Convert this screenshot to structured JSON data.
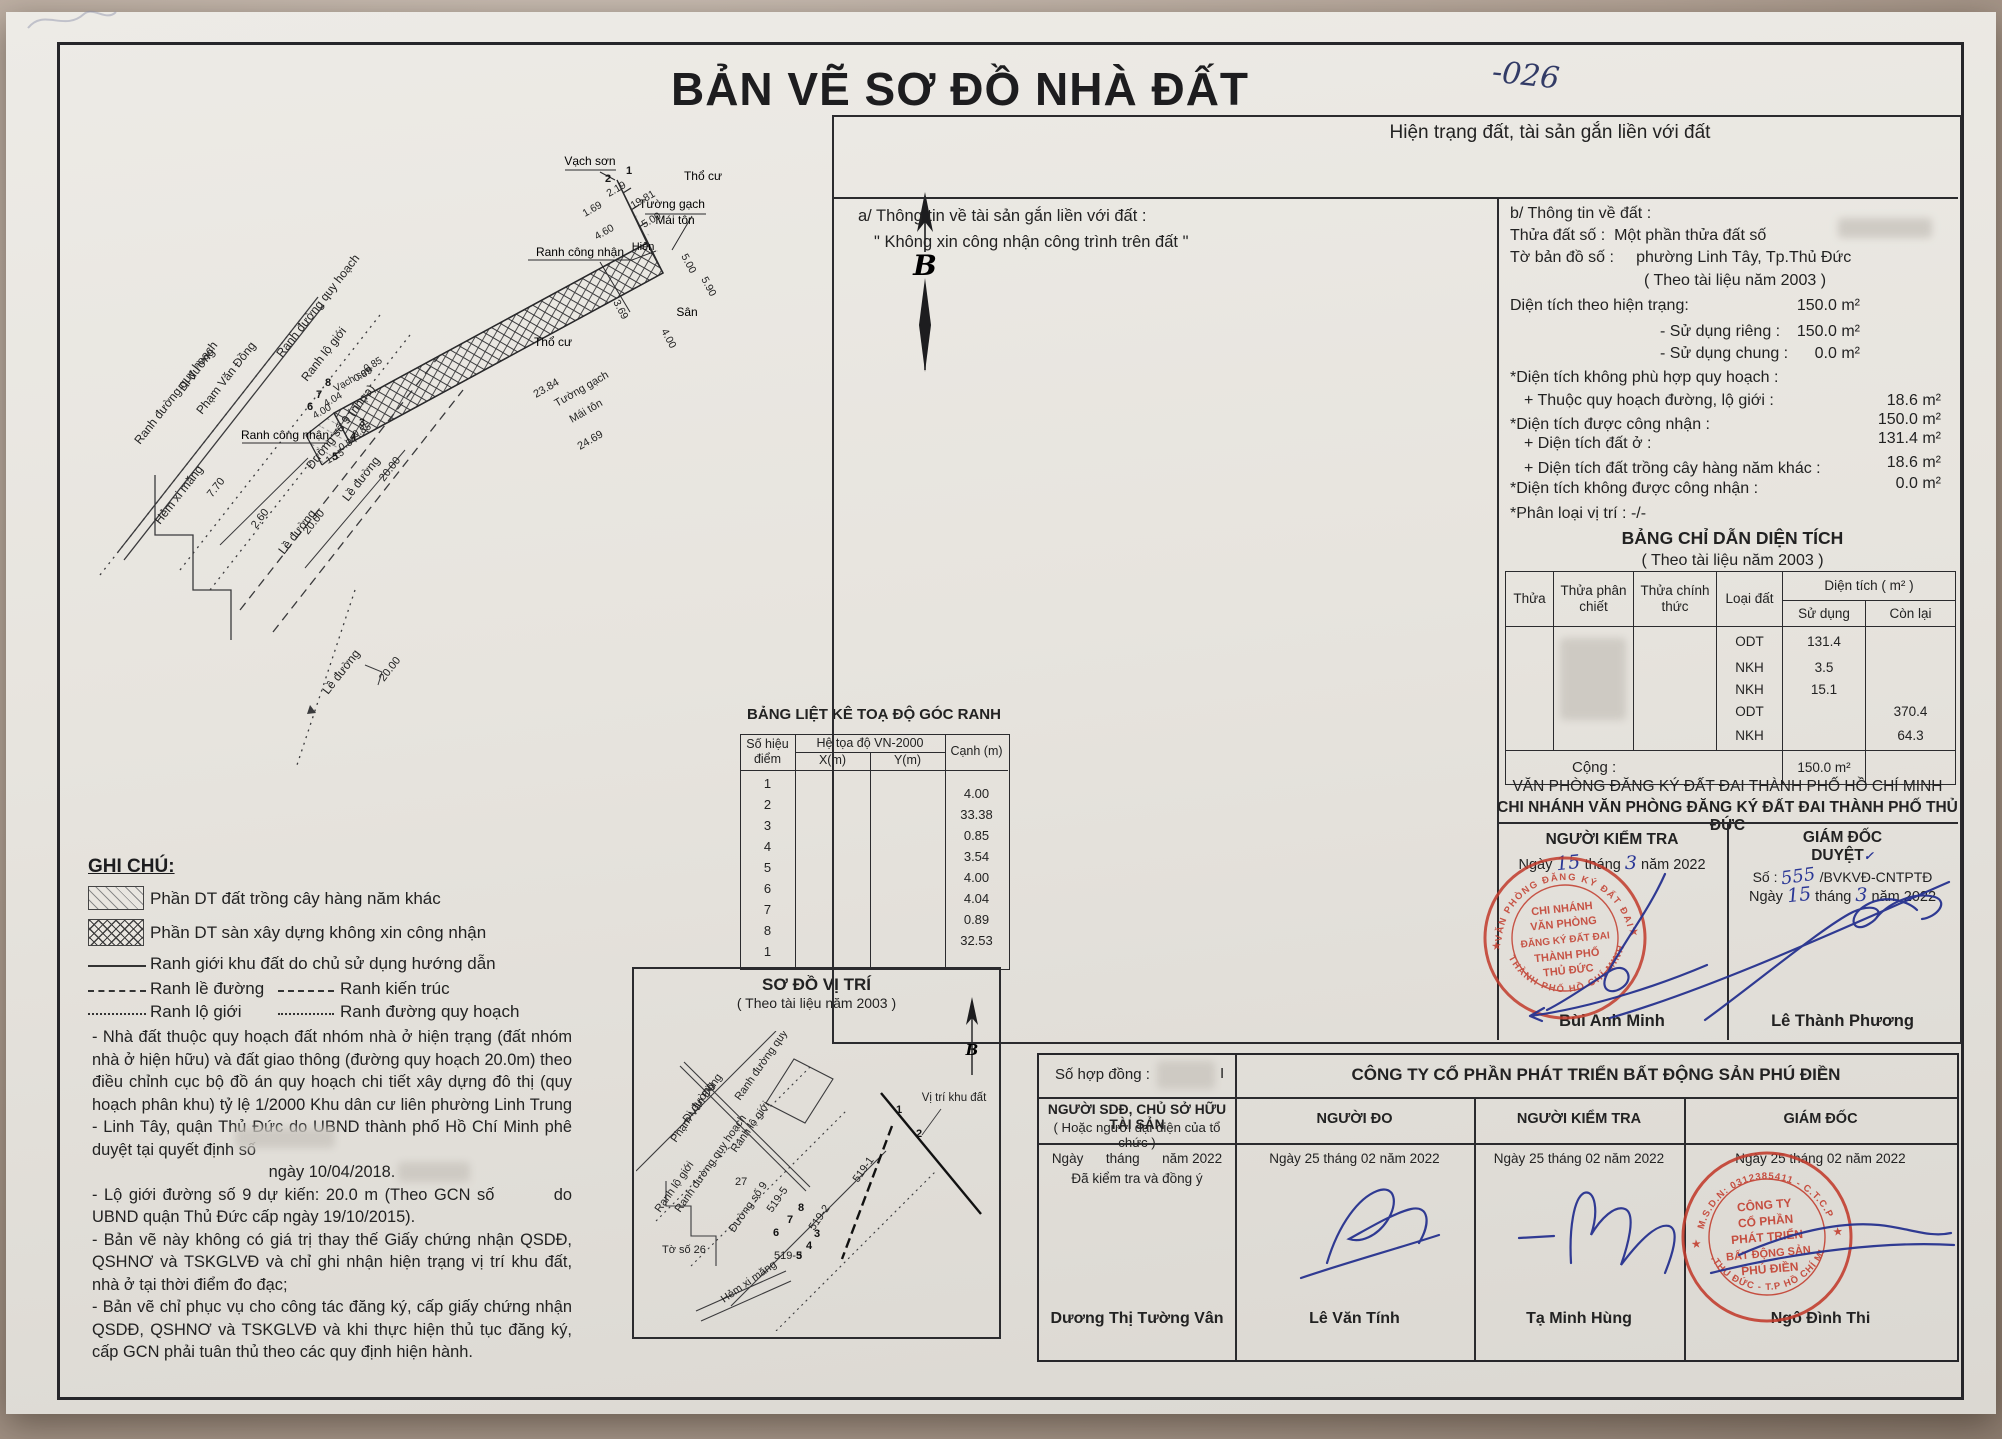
{
  "colors": {
    "paper": "#e7e4de",
    "ink": "#1d1d1f",
    "pen_blue": "#2a3796",
    "stamp_red": "#c23b2c"
  },
  "page": {
    "title": "BẢN VẼ SƠ ĐỒ NHÀ ĐẤT",
    "handwritten_code": "-026",
    "north": "B"
  },
  "drawing": {
    "labels": {
      "tuong_gach": "Tường gạch",
      "mai_ton": "Mái tôn",
      "vach_son": "Vạch sơn",
      "tho_cu": "Thổ cư",
      "san": "Sân",
      "hien": "Hiên",
      "ranh_cong_nhan": "Ranh công nhận",
      "ranh_duong_quy_hoach": "Ranh đường quy hoạch",
      "ranh_lo_gioi": "Ranh lộ giới",
      "ranh_kien_truc": "Ranh kiến trúc",
      "di_duong": "Đi đường",
      "pham_van_dong": "Phạm Văn Đồng",
      "duong_so_9_nhua": "Đường số 9 (nhựa)",
      "hem_xi_mang": "Hẻm xi măng",
      "le_duong": "Lề đường"
    },
    "dims": {
      "d2384": "23.84",
      "d2469": "24.69",
      "d369": "3.69",
      "d400": "4.00",
      "d500": "5.00",
      "d590": "5.90",
      "d169": "1.69",
      "d460": "4.60",
      "d219": "2.19",
      "d1981": "19.81",
      "d089": "0.89",
      "d404": "4.04",
      "d085": "0.85",
      "d115": "1.15",
      "d054": "0.54",
      "d2000": "20.00",
      "d770": "7.70",
      "d260": "2.60"
    },
    "points": [
      "1",
      "2",
      "3",
      "4",
      "5",
      "6",
      "7",
      "8"
    ]
  },
  "legend": {
    "heading": "GHI CHÚ:",
    "hatch1": "Phần DT đất trồng cây hàng năm khác",
    "hatch2": "Phần DT sàn xây dựng không xin công nhận",
    "solid": "Ranh giới khu đất do chủ sử dụng hướng dẫn",
    "dash1": "Ranh lề đường",
    "dash2": "Ranh kiến trúc",
    "dot1": "Ranh lộ giới",
    "dot2": "Ranh đường quy hoạch"
  },
  "notes": {
    "p1": "- Nhà đất thuộc quy hoạch đất nhóm nhà ở hiện trạng (đất nhóm nhà  ở hiện hữu) và đất giao thông (đường quy hoạch 20.0m) theo điều chỉnh cục bộ đồ án quy hoạch chi tiết xây dựng đô thị (quy hoạch phân khu) tỷ lệ 1/2000 Khu dân cư liên phường Linh Trung - Linh Tây, quận Thủ Đức do UBND thành phố Hồ Chí Minh phê duyệt tại quyết định số",
    "p1_date": "ngày 10/04/2018.",
    "p2": "- Lộ giới đường số 9 dự kiến: 20.0 m (Theo GCN số         do UBND quận Thủ Đức cấp ngày 19/10/2015).",
    "p3": "- Bản vẽ này không có giá trị thay thế Giấy chứng nhận QSDĐ, QSHNƠ và TSKGLVĐ và chỉ ghi nhận hiện trạng vị trí khu đất, nhà ở tại thời điểm đo đạc;",
    "p4": "- Bản vẽ chỉ phục vụ cho công tác đăng ký, cấp giấy chứng nhận QSDĐ, QSHNƠ và TSKGLVĐ và khi thực hiện thủ tục đăng ký, cấp GCN phải tuân thủ theo các quy định hiện hành."
  },
  "coord_table": {
    "title": "BẢNG LIỆT KÊ TOẠ ĐỘ GÓC RANH",
    "col_point1": "Số hiệu",
    "col_point2": "điểm",
    "col_sys": "Hệ tọa độ VN-2000",
    "col_x": "X(m)",
    "col_y": "Y(m)",
    "col_edge": "Cạnh (m)",
    "rows": [
      {
        "p": "1",
        "c": "4.00"
      },
      {
        "p": "2",
        "c": "33.38"
      },
      {
        "p": "3",
        "c": "0.85"
      },
      {
        "p": "4",
        "c": "3.54"
      },
      {
        "p": "5",
        "c": "4.00"
      },
      {
        "p": "6",
        "c": "4.04"
      },
      {
        "p": "7",
        "c": "0.89"
      },
      {
        "p": "8",
        "c": "32.53"
      },
      {
        "p": "1",
        "c": ""
      }
    ]
  },
  "location_map": {
    "title": "SƠ ĐỒ VỊ TRÍ",
    "subtitle": "( Theo tài liệu năm 2003 )",
    "labels": {
      "vi_tri": "Vị trí khu đất",
      "to_so": "Tờ số 26",
      "duong_so_9": "Đường số 9",
      "s519_1": "519-1",
      "s519_2": "519-2",
      "s519_3": "519-3",
      "s519_5": "519-5",
      "n27": "27"
    }
  },
  "info": {
    "header": "Hiện trạng đất, tài sản gắn liền với đất",
    "a_title": "a/ Thông tin về tài sản gắn liền với đất :",
    "a_note": "\" Không xin công nhận công trình trên đất \"",
    "b_title": "b/ Thông tin về đất :",
    "thua_label": "Thửa đất số :",
    "thua_value": "Một phần thửa đất số",
    "to_label": "Tờ bản đồ số :",
    "to_value": "phường Linh Tây, Tp.Thủ Đức",
    "doc_year": "( Theo tài liệu năm 2003 )",
    "rows": [
      {
        "label": "Diện tích theo hiện trạng:",
        "value": "150.0 m²"
      },
      {
        "label": "- Sử dụng riêng :",
        "value": "150.0 m²"
      },
      {
        "label": "- Sử dụng chung :",
        "value": "0.0 m²"
      },
      {
        "label": "*Diện tích không phù hợp quy hoạch :",
        "value": ""
      },
      {
        "label": "+ Thuộc quy hoạch đường, lộ giới :",
        "value": "18.6 m²"
      },
      {
        "label": "*Diện tích được công nhận :",
        "value": "150.0 m²"
      },
      {
        "label": "+ Diện tích đất ở :",
        "value": "131.4 m²"
      },
      {
        "label": "+ Diện tích đất trồng cây hàng năm khác :",
        "value": "18.6 m²"
      },
      {
        "label": "*Diện tích không được công nhận :",
        "value": "0.0 m²"
      },
      {
        "label": "*Phân loại vị trí :  -/-",
        "value": ""
      }
    ]
  },
  "area_table": {
    "title": "BẢNG CHỈ DẪN DIỆN TÍCH",
    "subtitle": "( Theo tài liệu năm 2003 )",
    "headers": {
      "thua": "Thửa",
      "phan_chiet": "Thửa phân chiết",
      "chinh_thuc": "Thửa chính thức",
      "loai_dat": "Loại đất",
      "dien_tich": "Diện tích   ( m² )",
      "su_dung": "Sử dụng",
      "con_lai": "Còn lại"
    },
    "rows": [
      {
        "loai": "ODT",
        "su_dung": "131.4",
        "con_lai": ""
      },
      {
        "loai": "NKH",
        "su_dung": "3.5",
        "con_lai": ""
      },
      {
        "loai": "NKH",
        "su_dung": "15.1",
        "con_lai": ""
      },
      {
        "loai": "ODT",
        "su_dung": "",
        "con_lai": "370.4"
      },
      {
        "loai": "NKH",
        "su_dung": "",
        "con_lai": "64.3"
      }
    ],
    "total_label": "Cộng :",
    "total_value": "150.0 m²"
  },
  "registry": {
    "line1": "VĂN PHÒNG ĐĂNG KÝ ĐẤT ĐAI THÀNH PHỐ HỒ CHÍ MINH",
    "line2": "CHI NHÁNH VĂN PHÒNG ĐĂNG KÝ ĐẤT ĐAI THÀNH PHỐ THỦ ĐỨC",
    "checker": {
      "title": "NGƯỜI KIỂM TRA",
      "d1": "Ngày",
      "day": "15",
      "d2": "tháng",
      "month": "3",
      "d3": "năm 2022",
      "name": "Bùi Anh Minh"
    },
    "director": {
      "title": "GIÁM ĐỐC",
      "duyet": "DUYỆT",
      "tick": "✓",
      "so_label": "Số :",
      "so_value": "555",
      "so_suffix": "/BVKVĐ-CNTPTĐ",
      "d1": "Ngày",
      "day": "15",
      "d2": "tháng",
      "month": "3",
      "d3": "năm 2022",
      "name": "Lê Thành Phương"
    },
    "stamp": {
      "arc_top": "VĂN PHÒNG ĐĂNG KÝ ĐẤT ĐAI",
      "arc_bottom": "THÀNH PHỐ HỒ CHÍ MINH",
      "l1": "CHI NHÁNH",
      "l2": "VĂN PHÒNG",
      "l3": "ĐĂNG KÝ ĐẤT ĐAI",
      "l4": "THÀNH PHỐ",
      "l5": "THỦ ĐỨC",
      "star": "★"
    }
  },
  "contract": {
    "so_hop_dong": "Số hợp đồng :",
    "so_hop_dong_value": "I",
    "company": "CÔNG TY CỔ PHẦN PHÁT TRIỂN BẤT ĐỘNG SẢN PHÚ ĐIỀN",
    "col1_title": "NGƯỜI SDĐ, CHỦ SỞ HỮU TÀI SẢN",
    "col1_sub": "( Hoặc người đại diện của tổ chức )",
    "col2_title": "NGƯỜI ĐO",
    "col3_title": "NGƯỜI KIỂM TRA",
    "col4_title": "GIÁM ĐỐC",
    "col1_date": "Ngày      tháng      năm 2022",
    "col1_note": "Đã kiểm tra và đồng ý",
    "date": "Ngày 25 tháng 02 năm 2022",
    "name1": "Dương Thị Tường Vân",
    "name2": "Lê Văn Tính",
    "name3": "Tạ Minh Hùng",
    "name4": "Ngô Đình Thi",
    "stamp": {
      "arc_top": "M.S.D.N: 0312385411 - C.T.C.P",
      "arc_bottom": "TP.THỦ ĐỨC - T.P HỒ CHÍ MINH",
      "l1": "CÔNG TY",
      "l2": "CỔ PHẦN",
      "l3": "PHÁT TRIỂN",
      "l4": "BẤT ĐỘNG SẢN",
      "l5": "PHÚ ĐIỀN",
      "star": "★"
    }
  }
}
